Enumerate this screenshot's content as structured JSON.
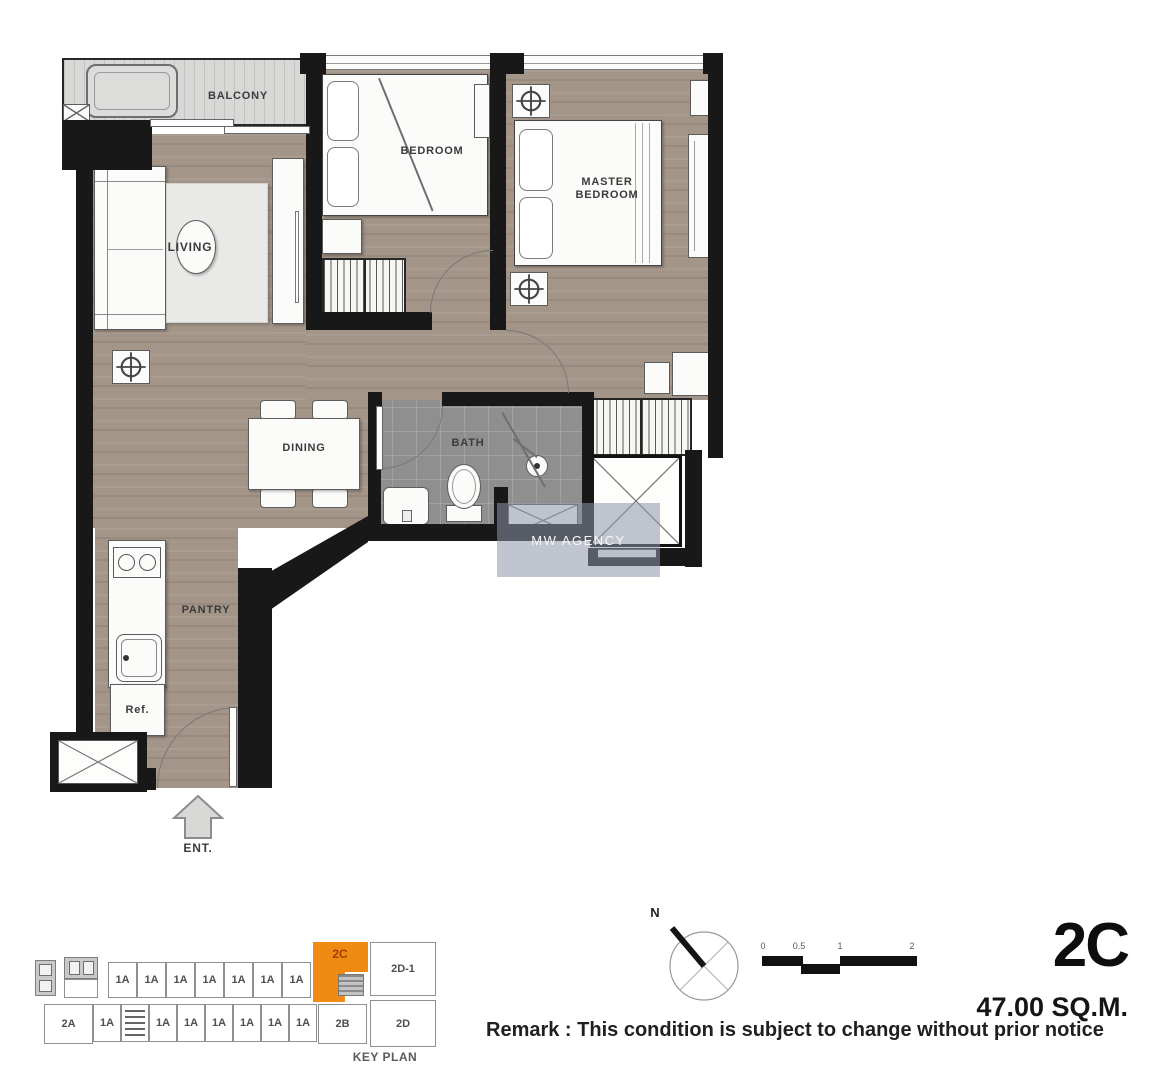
{
  "unit": {
    "name": "2C",
    "area": "47.00 SQ.M."
  },
  "remark": "Remark : This condition is subject to change without prior notice",
  "watermark": "MW AGENCY",
  "rooms": {
    "balcony": "BALCONY",
    "bedroom": "BEDROOM",
    "master_bedroom": "MASTER BEDROOM",
    "living": "LIVING",
    "dining": "DINING",
    "bath": "BATH",
    "pantry": "PANTRY",
    "fridge": "Ref.",
    "entrance": "ENT."
  },
  "compass": {
    "north": "N"
  },
  "scalebar": {
    "ticks": [
      "0",
      "0.5",
      "1",
      "2"
    ]
  },
  "keyplan": {
    "title": "KEY PLAN",
    "highlight": "2C",
    "highlight_color": "#EF8B13",
    "highlight_text_color": "#A33F00",
    "top_units": [
      "1A",
      "1A",
      "1A",
      "1A",
      "1A",
      "1A",
      "1A"
    ],
    "top_right": "2D-1",
    "bottom_left": "2A",
    "bottom_units": [
      "1A",
      "1A",
      "1A",
      "1A",
      "1A",
      "1A",
      "1A"
    ],
    "bottom_2b": "2B",
    "bottom_right": "2D"
  }
}
